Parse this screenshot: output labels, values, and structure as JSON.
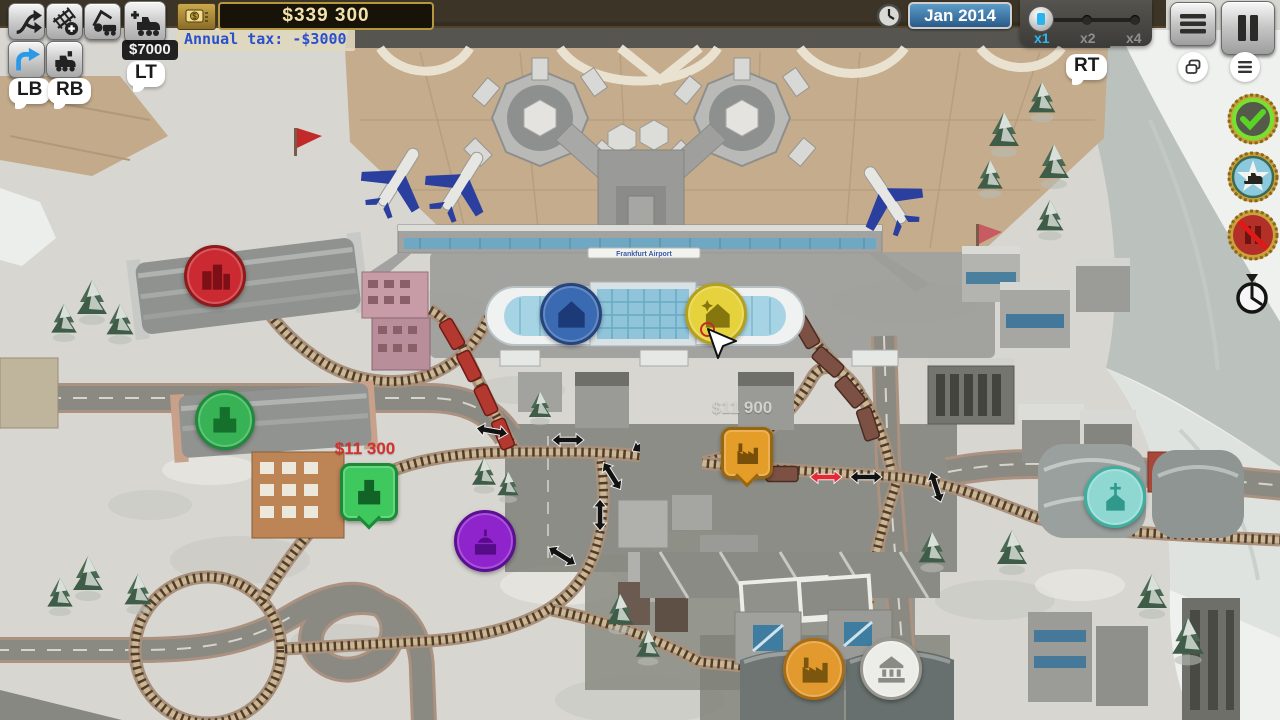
{
  "hud": {
    "money": {
      "balance": "$339 300",
      "annual_tax": "Annual tax: -$3000"
    },
    "date": "Jan 2014",
    "buy_train_price": "$7000",
    "controller_hints": {
      "lb": "LB",
      "rb": "RB",
      "lt": "LT",
      "rt": "RT"
    },
    "speed": {
      "options": [
        "x1",
        "x2",
        "x4"
      ],
      "selected": "x1"
    },
    "toolbar_buttons": [
      {
        "id": "junction",
        "icon": "junction-arrows-icon"
      },
      {
        "id": "build-track",
        "icon": "track-plus-icon"
      },
      {
        "id": "demolish",
        "icon": "crane-wrecking-ball-icon"
      },
      {
        "id": "buy-train",
        "icon": "train-plus-icon",
        "price": "$7000"
      },
      {
        "id": "route-signal",
        "icon": "blue-turn-arrow-icon"
      },
      {
        "id": "trains-list",
        "icon": "locomotive-icon"
      }
    ],
    "window_buttons": [
      {
        "id": "menu",
        "icon": "hamburger-icon"
      },
      {
        "id": "pause",
        "icon": "pause-icon"
      }
    ],
    "mini_buttons": [
      {
        "id": "windows",
        "icon": "copy-icon"
      },
      {
        "id": "options",
        "icon": "hamburger-icon"
      }
    ],
    "badges": [
      {
        "id": "objective-complete",
        "icon": "green-check-medal-icon"
      },
      {
        "id": "train-star-medal",
        "icon": "star-train-medal-icon"
      },
      {
        "id": "no-pause",
        "icon": "crossed-pause-medal-icon"
      }
    ],
    "timer_button": {
      "icon": "clock-arrow-icon"
    }
  },
  "map": {
    "airport_sign": "Frankfurt Airport",
    "colors": {
      "snow": "#d7d6d1",
      "apron": "#c4ac8d",
      "runway": "#56554f",
      "speed_accent": "#2fb6f0",
      "money_text": "#f1e3ab",
      "tax_text": "#2b50cc"
    },
    "price_labels": [
      {
        "text": "$11 300",
        "x": 365,
        "y": 449,
        "color": "#d4322e"
      },
      {
        "text": "$11 900",
        "x": 742,
        "y": 408,
        "color": "#d2d2cb"
      }
    ],
    "stations": [
      {
        "id": "city-red",
        "shape": "circle",
        "x": 212,
        "y": 273,
        "size": 56,
        "color": "#cc2a33",
        "border": "#8e1a1a",
        "icon": "city",
        "icon_color": "#7d1016"
      },
      {
        "id": "station-green",
        "shape": "circle",
        "x": 222,
        "y": 417,
        "size": 54,
        "color": "#37b355",
        "border": "#1f8a3a",
        "icon": "station",
        "icon_color": "#15702c"
      },
      {
        "id": "house-blue",
        "shape": "circle",
        "x": 568,
        "y": 311,
        "size": 56,
        "color": "#3a6ab2",
        "border": "#26457e",
        "icon": "house",
        "icon_color": "#1c3a78"
      },
      {
        "id": "house-yellow",
        "shape": "circle",
        "x": 713,
        "y": 311,
        "size": 56,
        "color": "#e6d23c",
        "border": "#b3a01c",
        "icon": "house-sparkle",
        "icon_color": "#86760e"
      },
      {
        "id": "capitol-purple",
        "shape": "circle",
        "x": 482,
        "y": 538,
        "size": 56,
        "color": "#8f24cc",
        "border": "#5c0f92",
        "icon": "capitol",
        "icon_color": "#560b88"
      },
      {
        "id": "church-teal",
        "shape": "circle",
        "x": 1112,
        "y": 494,
        "size": 56,
        "color": "#8fd8d2",
        "border": "#3fae9e",
        "icon": "church",
        "icon_color": "#2f998c"
      },
      {
        "id": "factory-orange",
        "shape": "circle",
        "x": 811,
        "y": 666,
        "size": 56,
        "color": "#e29a2e",
        "border": "#a86c14",
        "icon": "factory",
        "icon_color": "#7c560e"
      },
      {
        "id": "museum-white",
        "shape": "circle",
        "x": 888,
        "y": 666,
        "size": 56,
        "color": "#ecece8",
        "border": "#97978f",
        "icon": "museum",
        "icon_color": "#8b8b85"
      },
      {
        "id": "station-pin-green",
        "shape": "pin",
        "x": 366,
        "y": 489,
        "size": 52,
        "color": "#3fc85e",
        "border": "#1c8a36",
        "icon": "station",
        "icon_color": "#116426"
      },
      {
        "id": "factory-pin-orange",
        "shape": "pin",
        "x": 744,
        "y": 450,
        "size": 46,
        "color": "#e59d2a",
        "border": "#99660e",
        "icon": "factory",
        "icon_color": "#774f08"
      }
    ]
  }
}
